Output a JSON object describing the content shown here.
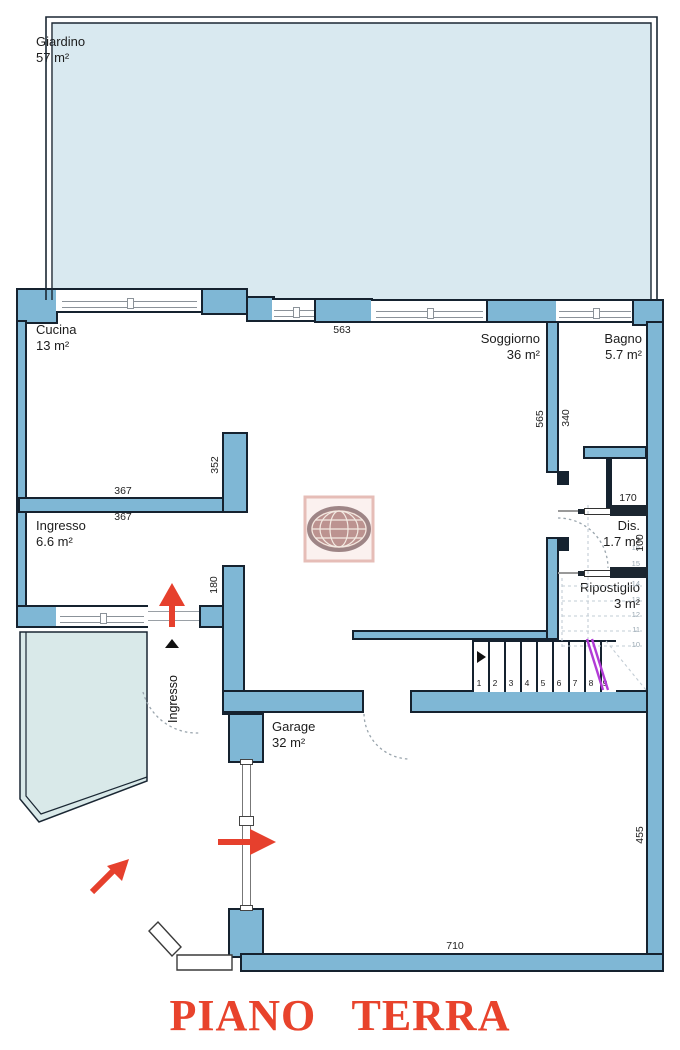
{
  "plan_title": "PIANO TERRA",
  "rooms": {
    "giardino": {
      "name": "Giardino",
      "area": "57 m²"
    },
    "cucina": {
      "name": "Cucina",
      "area": "13 m²"
    },
    "soggiorno": {
      "name": "Soggiorno",
      "area": "36 m²"
    },
    "bagno": {
      "name": "Bagno",
      "area": "5.7 m²"
    },
    "ingresso": {
      "name": "Ingresso",
      "area": "6.6 m²"
    },
    "dis": {
      "name": "Dis.",
      "area": "1.7 m²"
    },
    "ripostiglio": {
      "name": "Ripostiglio",
      "area": "3 m²"
    },
    "garage": {
      "name": "Garage",
      "area": "32 m²"
    }
  },
  "dims": {
    "top_wall": "563",
    "cucina_width_above": "367",
    "cucina_width_below": "367",
    "cucina_opening": "352",
    "soggiorno_height": "565",
    "bagno_height": "340",
    "ingresso_opening": "180",
    "alcove": "170",
    "dis_height": "100",
    "garage_width": "710",
    "garage_height": "455"
  },
  "stairs": {
    "down": [
      "1",
      "2",
      "3",
      "4",
      "5",
      "6",
      "7",
      "8",
      "9"
    ],
    "up": [
      "16",
      "15",
      "14",
      "13",
      "12",
      "11",
      "10"
    ]
  },
  "entrance": {
    "label": "Ingresso"
  },
  "colors": {
    "wall": "#7fb7d5",
    "outline": "#15222f",
    "garden": "#d9e9f0",
    "side_patch": "#d9e9e9",
    "accent_red": "#e6402d",
    "rail_purple": "#b23bd6",
    "title_red": "#e8432c"
  }
}
